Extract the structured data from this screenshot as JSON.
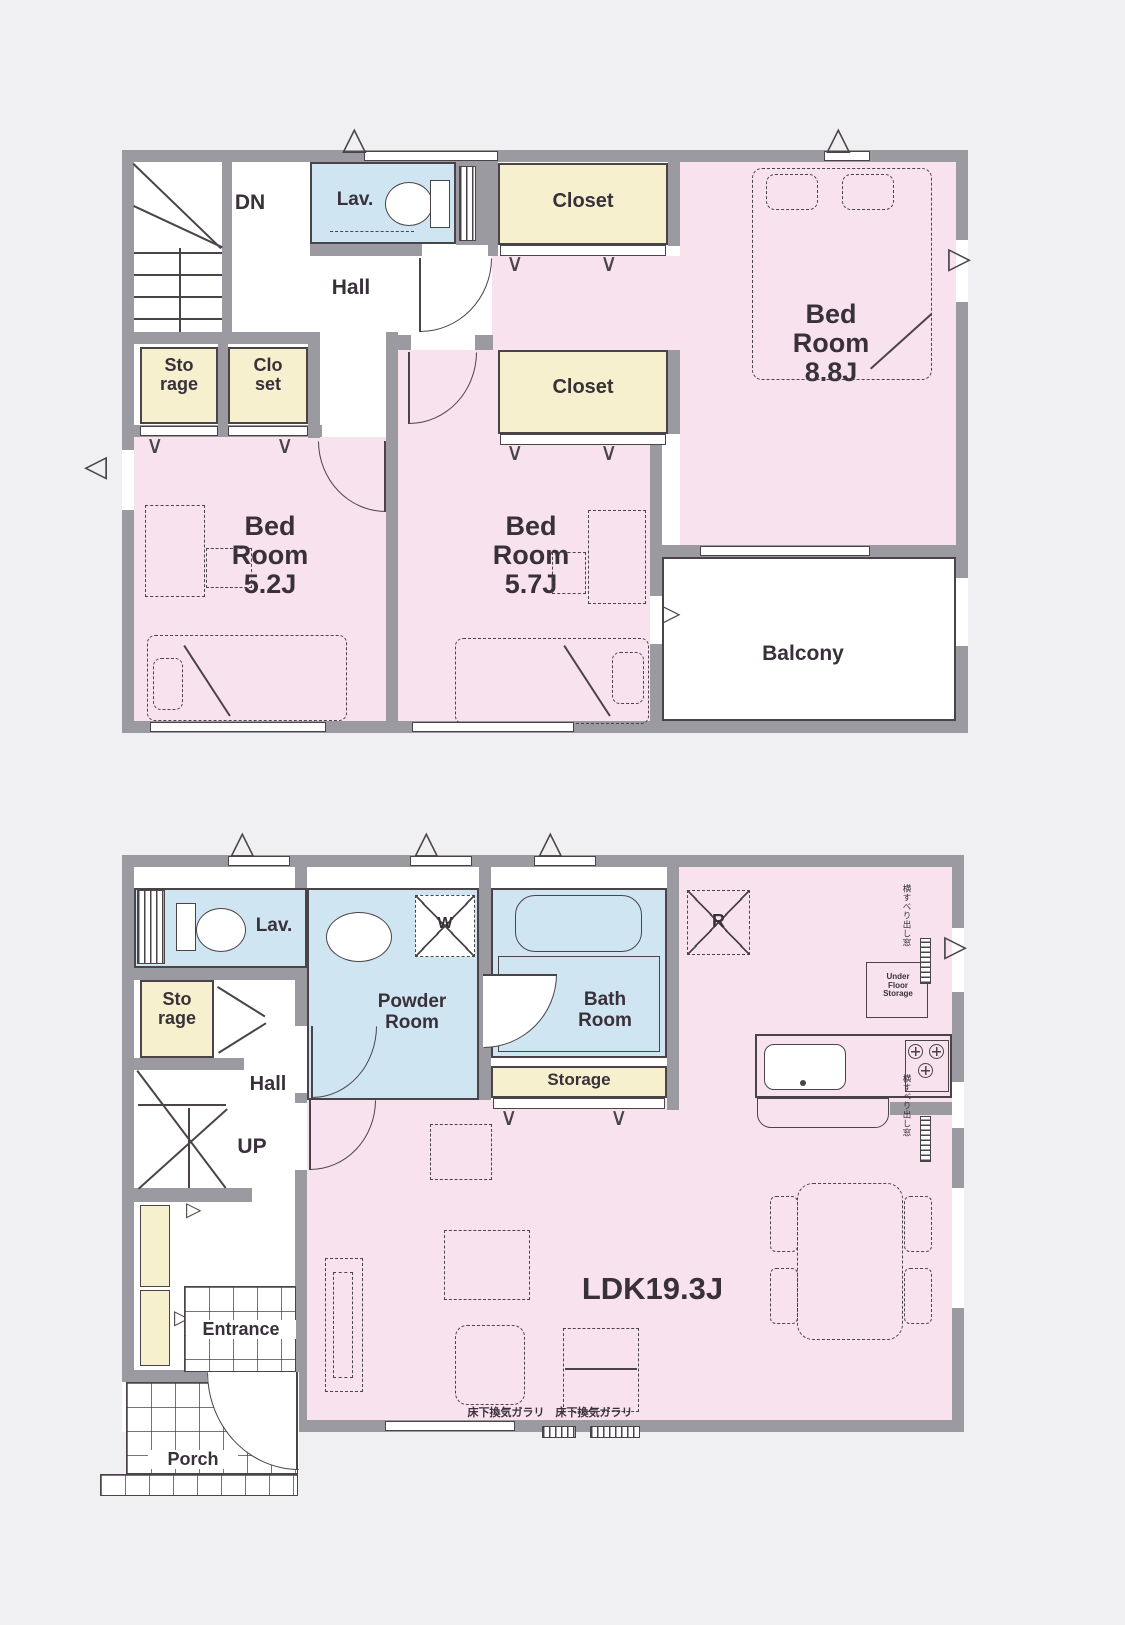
{
  "colors": {
    "bg": "#f0eff1",
    "paper": "#ffffff",
    "pink": "#f8e2ee",
    "blue": "#cfe5f2",
    "cream": "#f6f0cf",
    "wall": "#9b9aa0",
    "line": "#4a4449",
    "ink": "#39313a"
  },
  "icons": {
    "vent": "△",
    "arrow_right": "▷",
    "arrow_left": "◁",
    "door_v": "∨"
  },
  "floor2": {
    "dn": "DN",
    "hall": "Hall",
    "lav": "Lav.",
    "closet_top": "Closet",
    "closet_lower": "Closet",
    "storage": [
      "Sto",
      "rage"
    ],
    "closet_small": [
      "Clo",
      "set"
    ],
    "bedroom_main": [
      "Bed",
      "Room",
      "8.8J"
    ],
    "bedroom_left": [
      "Bed",
      "Room",
      "5.2J"
    ],
    "bedroom_center": [
      "Bed",
      "Room",
      "5.7J"
    ],
    "balcony": "Balcony"
  },
  "floor1": {
    "lav": "Lav.",
    "storage": [
      "Sto",
      "rage"
    ],
    "hall": "Hall",
    "up": "UP",
    "powder_room": [
      "Powder",
      "Room"
    ],
    "washer": "W",
    "bath_room": [
      "Bath",
      "Room"
    ],
    "storage_strip": "Storage",
    "fridge": "R",
    "under_floor": [
      "Under",
      "Floor",
      "Storage"
    ],
    "ldk": "LDK19.3J",
    "entrance": "Entrance",
    "porch": "Porch",
    "floor_vent_note": "床下換気ガラリ　床下換気ガラリ",
    "window_note_upper": "横すべり出し窓",
    "window_note_lower": "横すべり出し窓"
  }
}
